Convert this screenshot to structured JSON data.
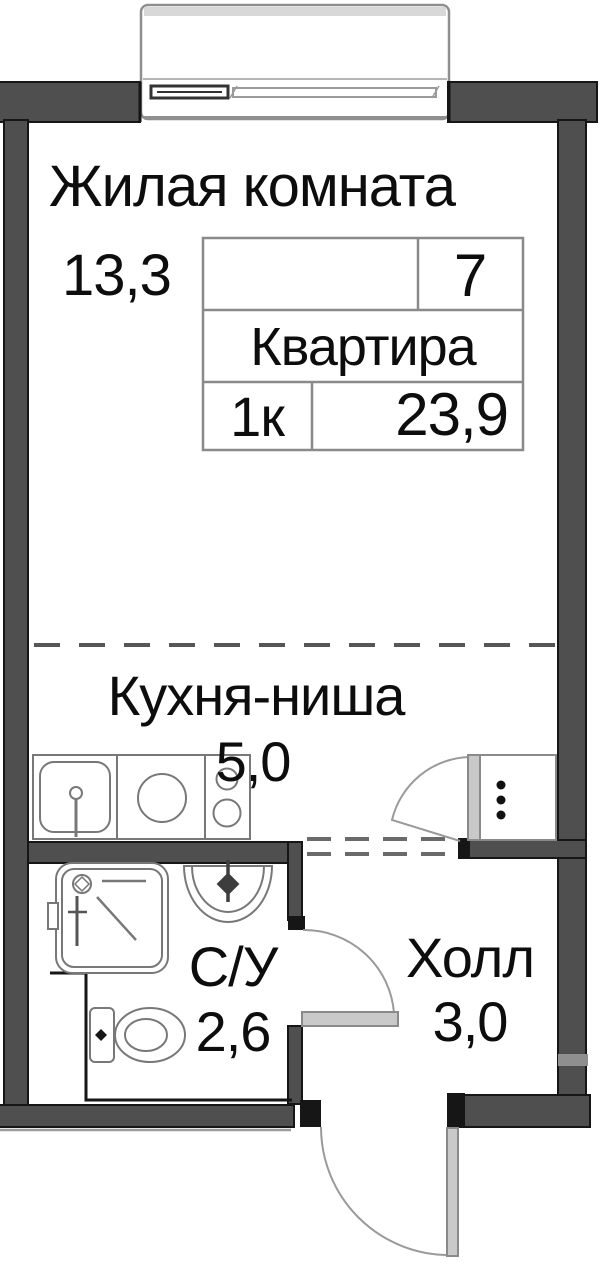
{
  "rooms": {
    "living": {
      "label": "Жилая комната",
      "area": "13,3"
    },
    "kitchen": {
      "label": "Кухня-ниша",
      "area": "5,0"
    },
    "bathroom": {
      "label": "С/У",
      "area": "2,6"
    },
    "hall": {
      "label": "Холл",
      "area": "3,0"
    }
  },
  "apartment_card": {
    "number": "7",
    "category": "Квартира",
    "rooms_count": "1к",
    "total_area": "23,9"
  },
  "fixtures": [
    "balcony",
    "window",
    "kitchen-sink",
    "kitchen-appliance",
    "stove-two-burners",
    "vent-shaft",
    "shower-cabin",
    "bathroom-sink",
    "toilet",
    "kitchen-door-swing",
    "bathroom-door-swing",
    "entry-door-swing"
  ],
  "colors": {
    "wall": "#4f4f4f",
    "outline": "#161616",
    "door_leaf": "#c9c9c9",
    "swing_arc": "#9a9a9a",
    "fixture_line": "#787878",
    "text": "#0d0d0d",
    "background": "#ffffff"
  }
}
